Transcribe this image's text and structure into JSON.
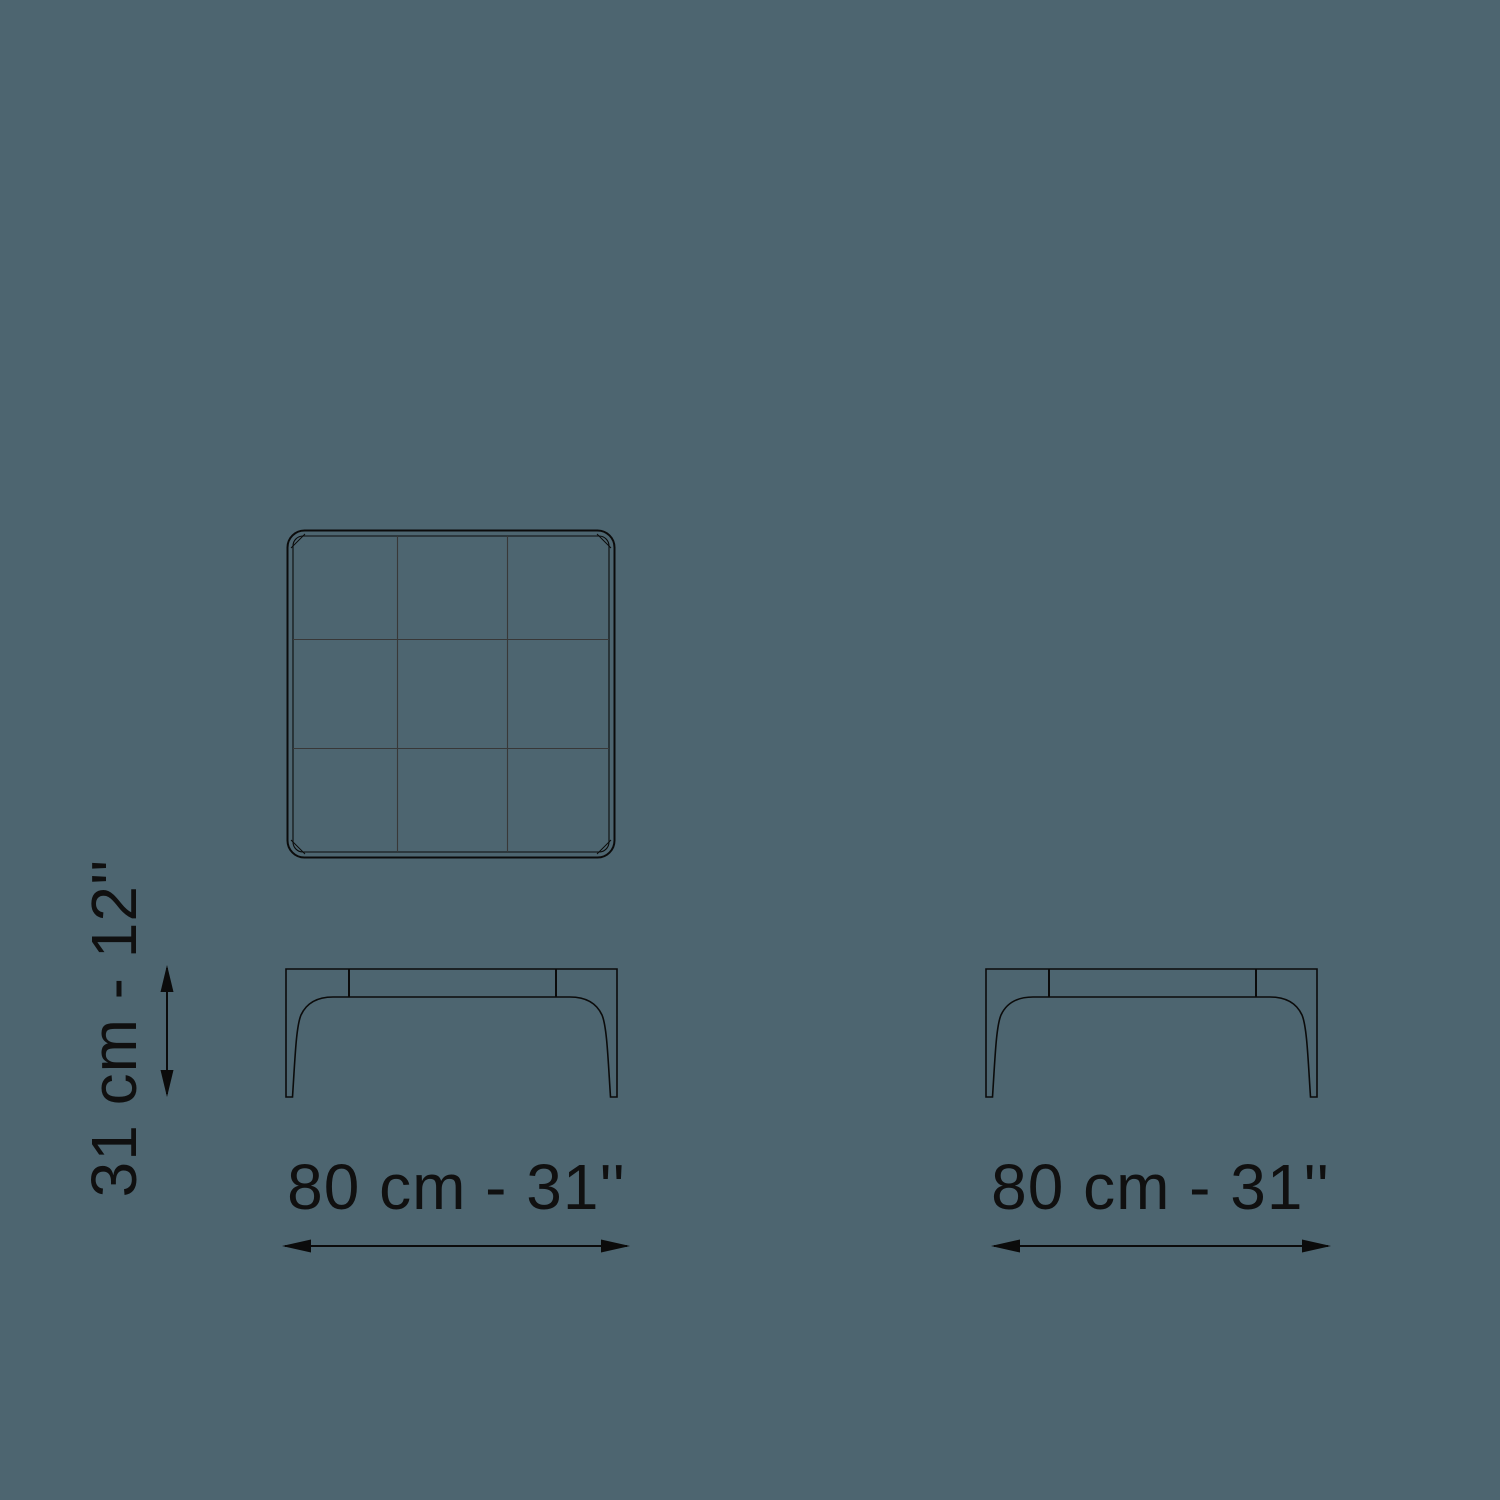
{
  "page": {
    "background_color": "#4d6570",
    "line_color": "#0b0b0b",
    "text_color": "#101010"
  },
  "diagram": {
    "type": "furniture-dimension-drawing",
    "views": {
      "top_view": {
        "name": "table top view",
        "grid": "3x3 rounded square panel"
      },
      "front_view_left": {
        "name": "table front elevation (left)"
      },
      "front_view_right": {
        "name": "table front elevation (right)"
      }
    },
    "labels": {
      "height": "31 cm - 12''",
      "width_left": "80 cm - 31''",
      "width_right": "80 cm - 31''"
    },
    "dimensions": {
      "width_cm": 80,
      "width_in": 31,
      "depth_cm": 80,
      "depth_in": 31,
      "height_cm": 31,
      "height_in": 12
    },
    "icons": {
      "horizontal_dimension_arrow": "double-headed-horizontal-arrow",
      "vertical_dimension_arrow": "double-headed-vertical-arrow"
    }
  }
}
